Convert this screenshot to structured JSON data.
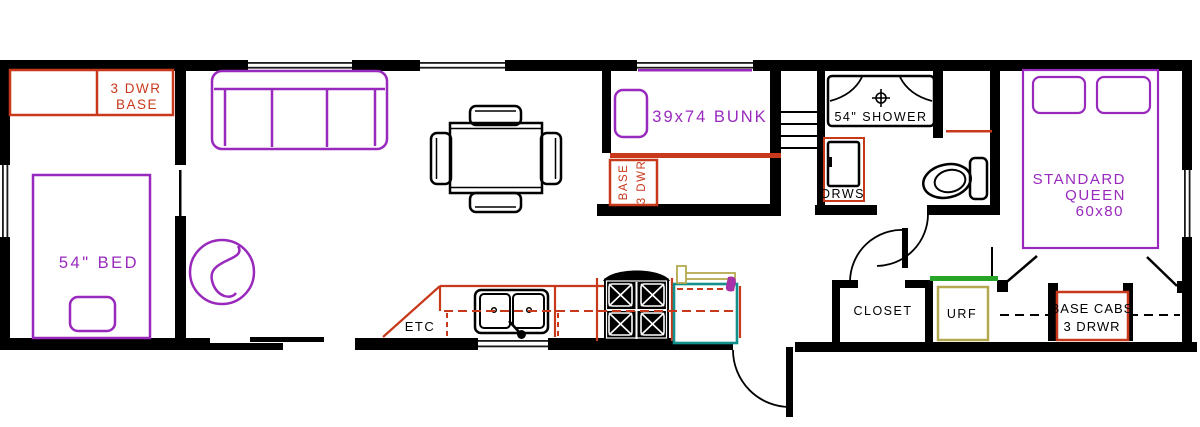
{
  "floorplan": {
    "left_bedroom": {
      "cabinet_line1": "3 DWR",
      "cabinet_line2": "BASE",
      "bed_label": "54\" BED"
    },
    "bunk_room": {
      "bunk_label": "39x74 BUNK",
      "base_line1": "BASE",
      "base_line2": "3 DWR"
    },
    "kitchen": {
      "counter_label": "ETC"
    },
    "bathroom": {
      "shower_label": "54\" SHOWER",
      "drawers_label": "DRWS"
    },
    "hallway": {
      "closet_label": "CLOSET",
      "urf_label": "URF"
    },
    "master_bedroom": {
      "bed_line1": "STANDARD",
      "bed_line2": "QUEEN",
      "bed_line3": "60x80",
      "cabs_line1": "BASE CABS",
      "cabs_line2": "3 DRWR"
    },
    "colors": {
      "wall_black": "#000000",
      "cabinet_red": "#c8391c",
      "furniture_purple": "#9929bd",
      "appliance_teal": "#12908c",
      "flap_olive": "#b4a94f",
      "shelf_green": "#28a428",
      "accent_magenta": "#a833a8"
    }
  }
}
